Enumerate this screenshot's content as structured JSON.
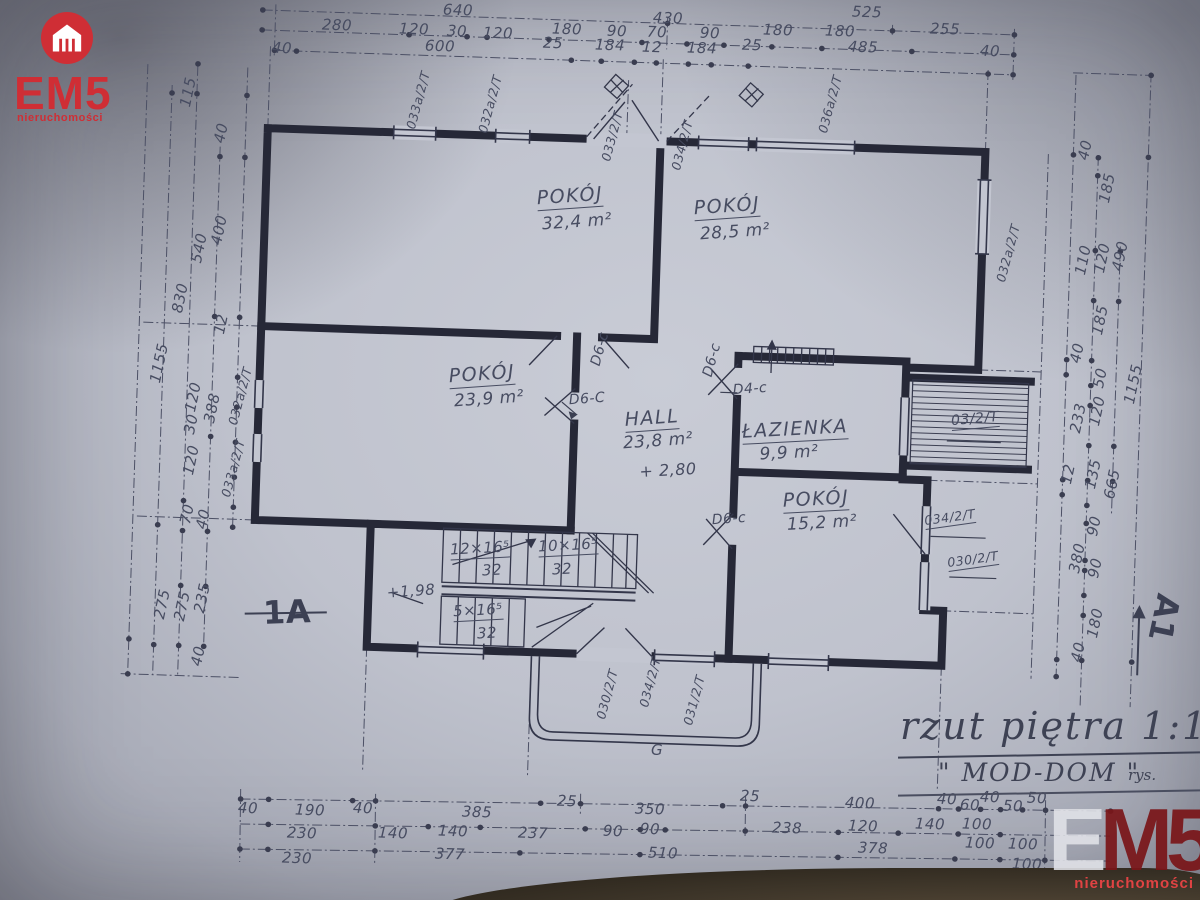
{
  "logo": {
    "brand": "EM5",
    "tagline": "nieruchomości"
  },
  "watermark": {
    "e": "E",
    "m5": "M5",
    "tagline": "nieruchomości"
  },
  "title_block": {
    "title": "rzut piętra 1:100",
    "project": "\" MOD-DOM \"",
    "author_label": "rys."
  },
  "colors": {
    "logo_red": "#cf2e35",
    "watermark_red": "#7a1519",
    "ink": "#262837",
    "pencil": "#474c61",
    "paper": "#c3c6d1"
  },
  "plan": {
    "rooms": [
      {
        "name": "POKÓJ",
        "area": "32,4 m²"
      },
      {
        "name": "POKÓJ",
        "area": "28,5 m²"
      },
      {
        "name": "POKÓJ",
        "area": "23,9 m²"
      },
      {
        "name": "HALL",
        "area": "23,8 m²"
      },
      {
        "name": "ŁAZIENKA",
        "area": "9,9 m²"
      },
      {
        "name": "POKÓJ",
        "area": "15,2 m²"
      }
    ],
    "labels": [
      {
        "t": "640",
        "x": 458,
        "y": 10,
        "r": 2
      },
      {
        "t": "430",
        "x": 668,
        "y": 18,
        "r": 2
      },
      {
        "t": "525",
        "x": 867,
        "y": 12,
        "r": 2
      },
      {
        "t": "280",
        "x": 337,
        "y": 25,
        "r": 2
      },
      {
        "t": "120",
        "x": 414,
        "y": 29,
        "r": 2
      },
      {
        "t": "30",
        "x": 457,
        "y": 31,
        "r": 2
      },
      {
        "t": "120",
        "x": 498,
        "y": 33,
        "r": 2
      },
      {
        "t": "180",
        "x": 567,
        "y": 29,
        "r": 2
      },
      {
        "t": "90",
        "x": 617,
        "y": 31,
        "r": 2
      },
      {
        "t": "70",
        "x": 657,
        "y": 32,
        "r": 2
      },
      {
        "t": "90",
        "x": 710,
        "y": 33,
        "r": 2
      },
      {
        "t": "180",
        "x": 778,
        "y": 30,
        "r": 2
      },
      {
        "t": "180",
        "x": 840,
        "y": 31,
        "r": 2
      },
      {
        "t": "255",
        "x": 945,
        "y": 29,
        "r": 2
      },
      {
        "t": "40",
        "x": 282,
        "y": 48,
        "r": 2
      },
      {
        "t": "600",
        "x": 440,
        "y": 46,
        "r": 2
      },
      {
        "t": "25",
        "x": 553,
        "y": 43,
        "r": 2
      },
      {
        "t": "184",
        "x": 610,
        "y": 45,
        "r": 2
      },
      {
        "t": "12",
        "x": 652,
        "y": 47,
        "r": 2
      },
      {
        "t": "184",
        "x": 702,
        "y": 48,
        "r": 2
      },
      {
        "t": "25",
        "x": 752,
        "y": 45,
        "r": 2
      },
      {
        "t": "485",
        "x": 863,
        "y": 47,
        "r": 2
      },
      {
        "t": "40",
        "x": 990,
        "y": 51,
        "r": 2
      },
      {
        "t": "40",
        "x": 248,
        "y": 808,
        "r": 2
      },
      {
        "t": "190",
        "x": 310,
        "y": 810,
        "r": 2
      },
      {
        "t": "40",
        "x": 363,
        "y": 808,
        "r": 2
      },
      {
        "t": "385",
        "x": 477,
        "y": 812,
        "r": 2
      },
      {
        "t": "25",
        "x": 567,
        "y": 801,
        "r": 2
      },
      {
        "t": "350",
        "x": 650,
        "y": 809,
        "r": 2
      },
      {
        "t": "25",
        "x": 750,
        "y": 796,
        "r": 2
      },
      {
        "t": "400",
        "x": 860,
        "y": 803,
        "r": 2
      },
      {
        "t": "40",
        "x": 947,
        "y": 799,
        "r": 2
      },
      {
        "t": "60",
        "x": 970,
        "y": 805,
        "r": 2
      },
      {
        "t": "40",
        "x": 990,
        "y": 797,
        "r": 2
      },
      {
        "t": "50",
        "x": 1013,
        "y": 806,
        "r": 2
      },
      {
        "t": "50",
        "x": 1037,
        "y": 798,
        "r": 2
      },
      {
        "t": "230",
        "x": 302,
        "y": 833,
        "r": 2
      },
      {
        "t": "140",
        "x": 393,
        "y": 833,
        "r": 2
      },
      {
        "t": "140",
        "x": 453,
        "y": 831,
        "r": 2
      },
      {
        "t": "237",
        "x": 533,
        "y": 833,
        "r": 2
      },
      {
        "t": "90",
        "x": 613,
        "y": 831,
        "r": 2
      },
      {
        "t": "90",
        "x": 650,
        "y": 829,
        "r": 2
      },
      {
        "t": "238",
        "x": 787,
        "y": 828,
        "r": 2
      },
      {
        "t": "120",
        "x": 863,
        "y": 826,
        "r": 2
      },
      {
        "t": "140",
        "x": 930,
        "y": 824,
        "r": 2
      },
      {
        "t": "100",
        "x": 977,
        "y": 824,
        "r": 2
      },
      {
        "t": "230",
        "x": 297,
        "y": 858,
        "r": 2
      },
      {
        "t": "377",
        "x": 450,
        "y": 854,
        "r": 2
      },
      {
        "t": "510",
        "x": 663,
        "y": 853,
        "r": 2
      },
      {
        "t": "378",
        "x": 873,
        "y": 848,
        "r": 2
      },
      {
        "t": "100",
        "x": 980,
        "y": 843,
        "r": 2
      },
      {
        "t": "100",
        "x": 1023,
        "y": 844,
        "r": 2
      },
      {
        "t": "100",
        "x": 1027,
        "y": 864,
        "r": 2
      },
      {
        "t": "115",
        "x": 188,
        "y": 92,
        "r": -78
      },
      {
        "t": "40",
        "x": 221,
        "y": 133,
        "r": -78
      },
      {
        "t": "400",
        "x": 219,
        "y": 230,
        "r": -78
      },
      {
        "t": "540",
        "x": 199,
        "y": 248,
        "r": -78
      },
      {
        "t": "830",
        "x": 180,
        "y": 298,
        "r": -78
      },
      {
        "t": "1155",
        "x": 159,
        "y": 363,
        "r": -78
      },
      {
        "t": "12",
        "x": 221,
        "y": 324,
        "r": -78
      },
      {
        "t": "120",
        "x": 193,
        "y": 397,
        "r": -78
      },
      {
        "t": "388",
        "x": 212,
        "y": 408,
        "r": -78
      },
      {
        "t": "30",
        "x": 191,
        "y": 424,
        "r": -78
      },
      {
        "t": "120",
        "x": 191,
        "y": 460,
        "r": -78
      },
      {
        "t": "70",
        "x": 187,
        "y": 514,
        "r": -78
      },
      {
        "t": "40",
        "x": 203,
        "y": 519,
        "r": -78
      },
      {
        "t": "275",
        "x": 162,
        "y": 604,
        "r": -78
      },
      {
        "t": "275",
        "x": 182,
        "y": 606,
        "r": -78
      },
      {
        "t": "235",
        "x": 202,
        "y": 598,
        "r": -78
      },
      {
        "t": "40",
        "x": 198,
        "y": 656,
        "r": -78
      },
      {
        "t": "40",
        "x": 1085,
        "y": 150,
        "r": -78
      },
      {
        "t": "185",
        "x": 1107,
        "y": 188,
        "r": -78
      },
      {
        "t": "110",
        "x": 1083,
        "y": 260,
        "r": -78
      },
      {
        "t": "120",
        "x": 1102,
        "y": 258,
        "r": -78
      },
      {
        "t": "490",
        "x": 1120,
        "y": 256,
        "r": -78
      },
      {
        "t": "185",
        "x": 1100,
        "y": 320,
        "r": -78
      },
      {
        "t": "40",
        "x": 1077,
        "y": 353,
        "r": -78
      },
      {
        "t": "50",
        "x": 1100,
        "y": 378,
        "r": -78
      },
      {
        "t": "233",
        "x": 1078,
        "y": 418,
        "r": -78
      },
      {
        "t": "120",
        "x": 1097,
        "y": 411,
        "r": -78
      },
      {
        "t": "1155",
        "x": 1133,
        "y": 384,
        "r": -78
      },
      {
        "t": "12",
        "x": 1068,
        "y": 474,
        "r": -78
      },
      {
        "t": "135",
        "x": 1093,
        "y": 474,
        "r": -78
      },
      {
        "t": "665",
        "x": 1112,
        "y": 484,
        "r": -78
      },
      {
        "t": "90",
        "x": 1094,
        "y": 526,
        "r": -78
      },
      {
        "t": "380",
        "x": 1077,
        "y": 558,
        "r": -78
      },
      {
        "t": "90",
        "x": 1095,
        "y": 568,
        "r": -78
      },
      {
        "t": "180",
        "x": 1095,
        "y": 623,
        "r": -78
      },
      {
        "t": "40",
        "x": 1078,
        "y": 652,
        "r": -78
      },
      {
        "t": "033a/2/T",
        "x": 418,
        "y": 100,
        "r": -75,
        "k": "win"
      },
      {
        "t": "032a/2/T",
        "x": 490,
        "y": 104,
        "r": -75,
        "k": "win"
      },
      {
        "t": "033/2/T",
        "x": 612,
        "y": 136,
        "r": -75,
        "k": "win"
      },
      {
        "t": "034/2/T",
        "x": 682,
        "y": 145,
        "r": -75,
        "k": "win"
      },
      {
        "t": "036a/2/T",
        "x": 830,
        "y": 104,
        "r": -75,
        "k": "win"
      },
      {
        "t": "032a/2/T",
        "x": 1008,
        "y": 253,
        "r": -75,
        "k": "win"
      },
      {
        "t": "032a/2/T",
        "x": 240,
        "y": 396,
        "r": -75,
        "k": "win"
      },
      {
        "t": "033a/2/T",
        "x": 233,
        "y": 468,
        "r": -75,
        "k": "win"
      },
      {
        "t": "030/2/T",
        "x": 607,
        "y": 694,
        "r": -75,
        "k": "win"
      },
      {
        "t": "034/2/T",
        "x": 650,
        "y": 682,
        "r": -75,
        "k": "win"
      },
      {
        "t": "031/2/T",
        "x": 694,
        "y": 700,
        "r": -75,
        "k": "win"
      },
      {
        "t": "034/2/T",
        "x": 950,
        "y": 518,
        "r": -8,
        "k": "win",
        "u": 1
      },
      {
        "t": "030/2/T",
        "x": 973,
        "y": 560,
        "r": -8,
        "k": "win",
        "u": 1
      },
      {
        "t": "03/2/T",
        "x": 975,
        "y": 420,
        "r": -5,
        "k": "win",
        "s": 14,
        "u": 1
      },
      {
        "t": "D6-C",
        "x": 587,
        "y": 399,
        "r": -4,
        "k": "door"
      },
      {
        "t": "D4-c",
        "x": 750,
        "y": 389,
        "r": -4,
        "k": "door"
      },
      {
        "t": "D6-c",
        "x": 729,
        "y": 519,
        "r": -4,
        "k": "door"
      },
      {
        "t": "D6-c",
        "x": 600,
        "y": 349,
        "r": -75,
        "k": "door"
      },
      {
        "t": "D6-c",
        "x": 712,
        "y": 360,
        "r": -75,
        "k": "door"
      },
      {
        "t": "POKÓJ",
        "x": 570,
        "y": 197,
        "r": -4,
        "k": "room",
        "u": 1
      },
      {
        "t": "32,4 m²",
        "x": 577,
        "y": 222,
        "r": -4,
        "k": "area"
      },
      {
        "t": "POKÓJ",
        "x": 727,
        "y": 207,
        "r": -4,
        "k": "room",
        "u": 1
      },
      {
        "t": "28,5 m²",
        "x": 735,
        "y": 232,
        "r": -4,
        "k": "area"
      },
      {
        "t": "POKÓJ",
        "x": 482,
        "y": 375,
        "r": -4,
        "k": "room",
        "u": 1
      },
      {
        "t": "23,9 m²",
        "x": 489,
        "y": 399,
        "r": -4,
        "k": "area"
      },
      {
        "t": "HALL",
        "x": 652,
        "y": 419,
        "r": -4,
        "k": "room",
        "u": 1
      },
      {
        "t": "23,8 m²",
        "x": 658,
        "y": 441,
        "r": -4,
        "k": "area"
      },
      {
        "t": "ŁAZIENKA",
        "x": 795,
        "y": 430,
        "r": -3,
        "k": "room",
        "u": 1
      },
      {
        "t": "9,9 m²",
        "x": 789,
        "y": 453,
        "r": -3,
        "k": "area"
      },
      {
        "t": "POKÓJ",
        "x": 816,
        "y": 500,
        "r": -3,
        "k": "room",
        "u": 1
      },
      {
        "t": "15,2 m²",
        "x": 822,
        "y": 523,
        "r": -3,
        "k": "area"
      },
      {
        "t": "+ 2,80",
        "x": 668,
        "y": 470,
        "r": -3,
        "k": "lvl"
      },
      {
        "t": "+1,98",
        "x": 411,
        "y": 591,
        "r": -4,
        "k": "lvl",
        "s": 15
      },
      {
        "t": "12×16⁵",
        "x": 480,
        "y": 549,
        "r": -3,
        "k": "stair",
        "u": 1
      },
      {
        "t": "32",
        "x": 492,
        "y": 570,
        "r": -3,
        "k": "stair"
      },
      {
        "t": "10×16⁵",
        "x": 568,
        "y": 546,
        "r": -3,
        "k": "stair",
        "u": 1
      },
      {
        "t": "32",
        "x": 562,
        "y": 569,
        "r": -3,
        "k": "stair"
      },
      {
        "t": "5×16⁵",
        "x": 478,
        "y": 611,
        "r": -3,
        "k": "stair",
        "u": 1
      },
      {
        "t": "32",
        "x": 487,
        "y": 633,
        "r": -3,
        "k": "stair"
      },
      {
        "t": "1A",
        "x": 287,
        "y": 612,
        "r": -2,
        "k": "sec"
      },
      {
        "t": "A1",
        "x": 1164,
        "y": 618,
        "r": 102,
        "k": "sec"
      },
      {
        "t": "G",
        "x": 657,
        "y": 750,
        "s": 15,
        "k": "door"
      }
    ]
  }
}
